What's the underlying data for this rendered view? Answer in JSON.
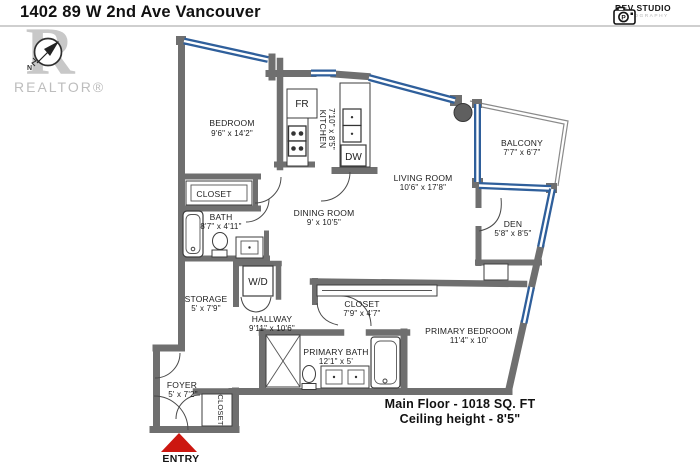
{
  "header": {
    "title": "1402 89 W 2nd Ave Vancouver"
  },
  "branding": {
    "studio": {
      "name": "REV STUDIO",
      "tagline": "PHOTOGRAPHY",
      "camera_glyph": "P"
    },
    "realtor": {
      "logo_letter": "R",
      "wordmark": "REALTOR®"
    },
    "compass": {
      "north_label": "N"
    }
  },
  "rooms": {
    "bedroom": {
      "name": "BEDROOM",
      "dims": "9'6\" x 14'2\""
    },
    "closet_bedroom": {
      "name": "CLOSET",
      "dims": ""
    },
    "bath": {
      "name": "BATH",
      "dims": "8'7\" x 4'11\""
    },
    "kitchen": {
      "name": "KITCHEN",
      "dims": "7'10\" x 8'5\""
    },
    "dining": {
      "name": "DINING ROOM",
      "dims": "9' x 10'5\""
    },
    "living": {
      "name": "LIVING ROOM",
      "dims": "10'6\" x 17'8\""
    },
    "balcony": {
      "name": "BALCONY",
      "dims": "7'7\" x 6'7\""
    },
    "den": {
      "name": "DEN",
      "dims": "5'8\" x 8'5\""
    },
    "storage": {
      "name": "STORAGE",
      "dims": "5' x 7'9\""
    },
    "hallway": {
      "name": "HALLWAY",
      "dims": "9'11\" x 10'6\""
    },
    "closet_hall": {
      "name": "CLOSET",
      "dims": "7'9\" x 4'7\""
    },
    "primary_bath": {
      "name": "PRIMARY BATH",
      "dims": "12'1\" x 5'"
    },
    "primary_bedroom": {
      "name": "PRIMARY BEDROOM",
      "dims": "11'4\" x 10'"
    },
    "foyer": {
      "name": "FOYER",
      "dims": "5' x 7'2\""
    },
    "closet_foyer": {
      "name": "CLOSET",
      "dims": ""
    }
  },
  "appliances": {
    "fridge": "FR",
    "dishwasher": "DW",
    "washer_dryer": "W/D"
  },
  "entry": {
    "label": "ENTRY"
  },
  "footer": {
    "area": "Main Floor - 1018  SQ. FT",
    "ceiling": "Ceiling height - 8'5\""
  },
  "colors": {
    "wall": "#6f6f6f",
    "window": "#2f5f9b",
    "entry": "#cc1710",
    "watermark": "#c8c8c8",
    "rule": "#cfcfcf"
  }
}
